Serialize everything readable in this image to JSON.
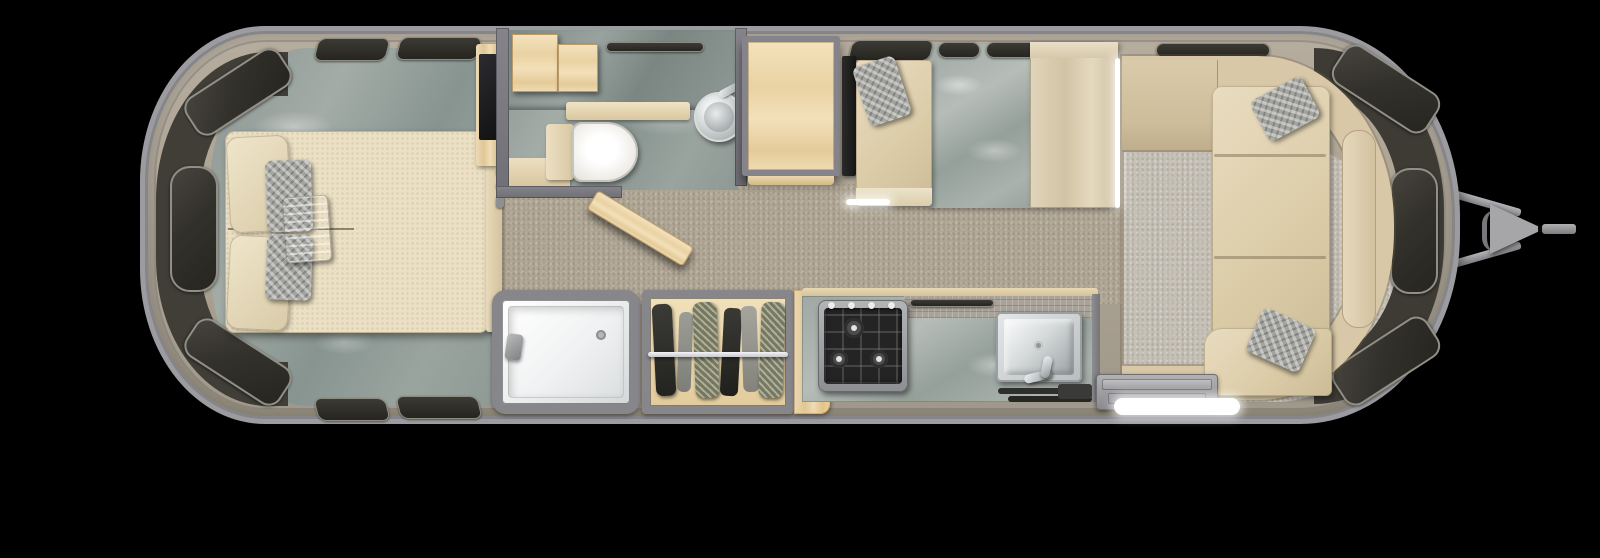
{
  "scene": {
    "type": "floor_plan",
    "subject": "travel-trailer-top-view-3d-floor-plan",
    "orientation": "hitch-on-right",
    "background_color": "#000000"
  },
  "rooms": [
    {
      "name": "rear-bedroom",
      "features": [
        "queen-bed-mattress",
        "cream-pillows",
        "gray-accent-pillows",
        "folded-throw-blanket",
        "bed-footboard",
        "tv-cabinet",
        "marble-floor",
        "wraparound-rear-windows"
      ]
    },
    {
      "name": "bathroom",
      "features": [
        "overhead-cabinet",
        "marble-vanity-counter",
        "toilet",
        "round-vessel-sink",
        "sink-faucet",
        "vent-window",
        "open-swing-door",
        "vanity-base-cabinet",
        "door-hardware-hooks"
      ]
    },
    {
      "name": "shower-room",
      "features": [
        "white-shower-pan",
        "hand-shower-head",
        "floor-drain"
      ]
    },
    {
      "name": "wardrobe-closet",
      "features": [
        "hanging-rod",
        "hanging-clothes",
        "wood-floor"
      ]
    },
    {
      "name": "dinette",
      "features": [
        "wood-table",
        "dark-side-panel",
        "bench-seat-with-pillow",
        "marble-tile-floor",
        "tall-cabinet",
        "led-edge-strips"
      ]
    },
    {
      "name": "galley-kitchen",
      "features": [
        "marble-countertop",
        "mosaic-backsplash",
        "three-burner-cooktop",
        "burner-knobs",
        "stainless-sink",
        "sink-faucet",
        "window-slot",
        "floor-mats",
        "side-glow-cabinet"
      ]
    },
    {
      "name": "entry",
      "features": [
        "step-well",
        "step-treads",
        "illuminated-entry-rail",
        "floor-mat"
      ]
    },
    {
      "name": "front-lounge",
      "features": [
        "wraparound-sofa-backrest",
        "sofa-shelf-return",
        "chaise-seat-cushions",
        "bottom-seat-cushion",
        "lumbar-panel",
        "two-accent-pillows",
        "light-carpet",
        "wraparound-front-windows"
      ]
    }
  ],
  "exterior": [
    "rounded-aluminum-shell",
    "shell-rim",
    "side-wall-windows",
    "a-frame-hitch-bars",
    "hitch-triangle-plate",
    "tongue-jack",
    "hitch-coupler"
  ],
  "palette": {
    "shell_body": "#b2a999",
    "shell_rim": "#9a9a9e",
    "interior_wall": "#7a7a7f",
    "window_glass": "#33312b",
    "window_frame": "#908e85",
    "carpet_main": "#b0a695",
    "carpet_lounge": "#c6c1b7",
    "marble_gray": "#96a09c",
    "marble_tile": "#a6aeaa",
    "wood_maple": "#e9d2a3",
    "cushion_cream": "#dccda9",
    "pillow_gray": "#a3a39f",
    "fixture_white": "#f4f5f5",
    "cooktop_black": "#242424",
    "stainless": "#c9cccd",
    "led_white": "#ffffff",
    "hitch_gray": "#a0a0a3"
  }
}
